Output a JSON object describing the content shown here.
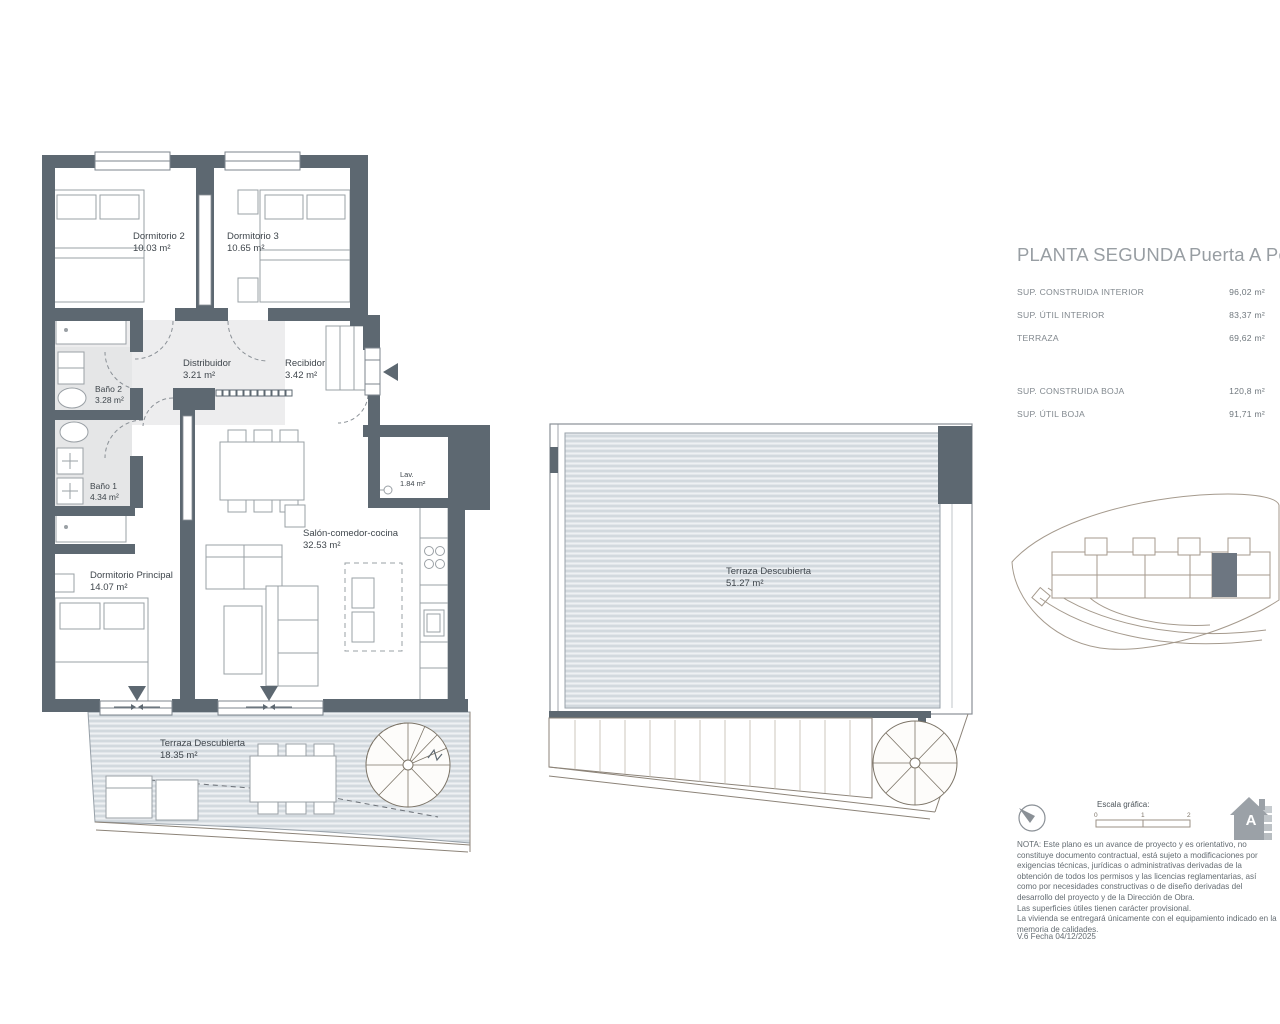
{
  "title": {
    "main": "PLANTA SEGUNDA",
    "sub": "Puerta A Portal"
  },
  "surfaces": {
    "rows": [
      {
        "label": "SUP. CONSTRUIDA INTERIOR",
        "value": "96,02 m²"
      },
      {
        "label": "SUP. ÚTIL INTERIOR",
        "value": "83,37 m²"
      },
      {
        "label": "TERRAZA",
        "value": "69,62 m²"
      },
      {
        "label": "SUP. CONSTRUIDA BOJA",
        "value": "120,8 m²"
      },
      {
        "label": "SUP. ÚTIL BOJA",
        "value": "91,71 m²"
      }
    ]
  },
  "rooms": {
    "dormitorio2": {
      "name": "Dormitorio 2",
      "area": "10.03 m²"
    },
    "dormitorio3": {
      "name": "Dormitorio 3",
      "area": "10.65 m²"
    },
    "distribuidor": {
      "name": "Distribuidor",
      "area": "3.21 m²"
    },
    "recibidor": {
      "name": "Recibidor",
      "area": "3.42 m²"
    },
    "bano2": {
      "name": "Baño 2",
      "area": "3.28 m²"
    },
    "bano1": {
      "name": "Baño 1",
      "area": "4.34 m²"
    },
    "lavadero": {
      "name": "Lav.",
      "area": "1.84 m²"
    },
    "salon": {
      "name": "Salón-comedor-cocina",
      "area": "32.53 m²"
    },
    "dormitorio_principal": {
      "name": "Dormitorio Principal",
      "area": "14.07 m²"
    },
    "terraza_baja": {
      "name": "Terraza Descubierta",
      "area": "18.35 m²"
    },
    "terraza_superior": {
      "name": "Terraza Descubierta",
      "area": "51.27 m²"
    }
  },
  "scale": {
    "label": "Escala gráfica:",
    "ticks": [
      "0",
      "1",
      "2"
    ]
  },
  "logo": {
    "letter": "A"
  },
  "note": {
    "p1": "NOTA: Este plano es un avance de proyecto y es orientativo, no constituye documento contractual, está sujeto a modificaciones por exigencias técnicas, jurídicas o administrativas derivadas de la obtención de todos los permisos y las licencias reglamentarias, así como por necesidades constructivas o de diseño derivadas del desarrollo del proyecto y de la Dirección de Obra.",
    "p2": "Las superficies útiles tienen carácter provisional.",
    "p3": "La vivienda se entregará únicamente con el equipamiento indicado en la memoria de calidades."
  },
  "version": "V.6 Fecha 04/12/2025",
  "colors": {
    "wall": "#5d6871",
    "deck": "#e2e6ea",
    "deck_stripe": "#c3ccd3",
    "bath_floor": "#e5e6e7",
    "furniture_line": "#9aa0a5",
    "site_line": "#a59a8d",
    "highlight_unit": "#6d7681",
    "text_dark": "#3f464c",
    "text_grey": "#81888e"
  }
}
